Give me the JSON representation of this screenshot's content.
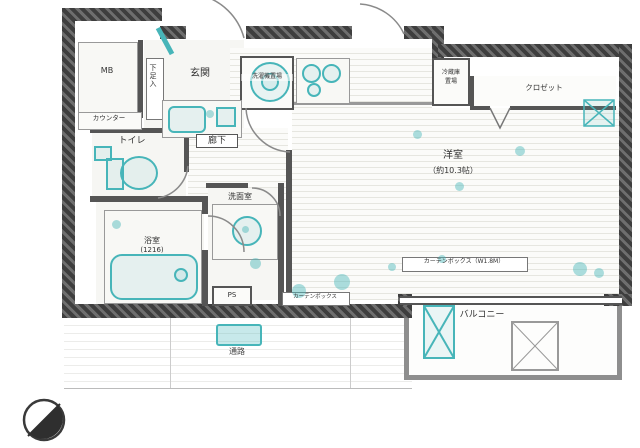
{
  "floorplan": {
    "labels": {
      "mb": "MB",
      "entrance": "玄関",
      "shoe_cabinet": "下足入",
      "counter": "カウンター",
      "toilet": "トイレ",
      "hallway": "廊下",
      "washroom": "洗面室",
      "bathroom": "浴室",
      "bathroom_size": "(1216)",
      "washing_machine": "洗濯機置場",
      "fridge_line1": "冷蔵庫",
      "fridge_line2": "置場",
      "closet": "クロゼット",
      "western_room": "洋室",
      "western_room_size": "（約10.3帖）",
      "pipe_space": "PS",
      "curtain_box": "カーテンボックス",
      "curtain_box_w": "カーテンボックス（W1.8M）",
      "balcony": "バルコニー",
      "passage": "通路"
    },
    "colors": {
      "wall": "#3e3e3e",
      "wall_hatch": "#6e6e6e",
      "partition": "#555555",
      "fixture_teal": "#47b5b9",
      "floor_line": "#e6e6e0",
      "text": "#333333"
    }
  }
}
